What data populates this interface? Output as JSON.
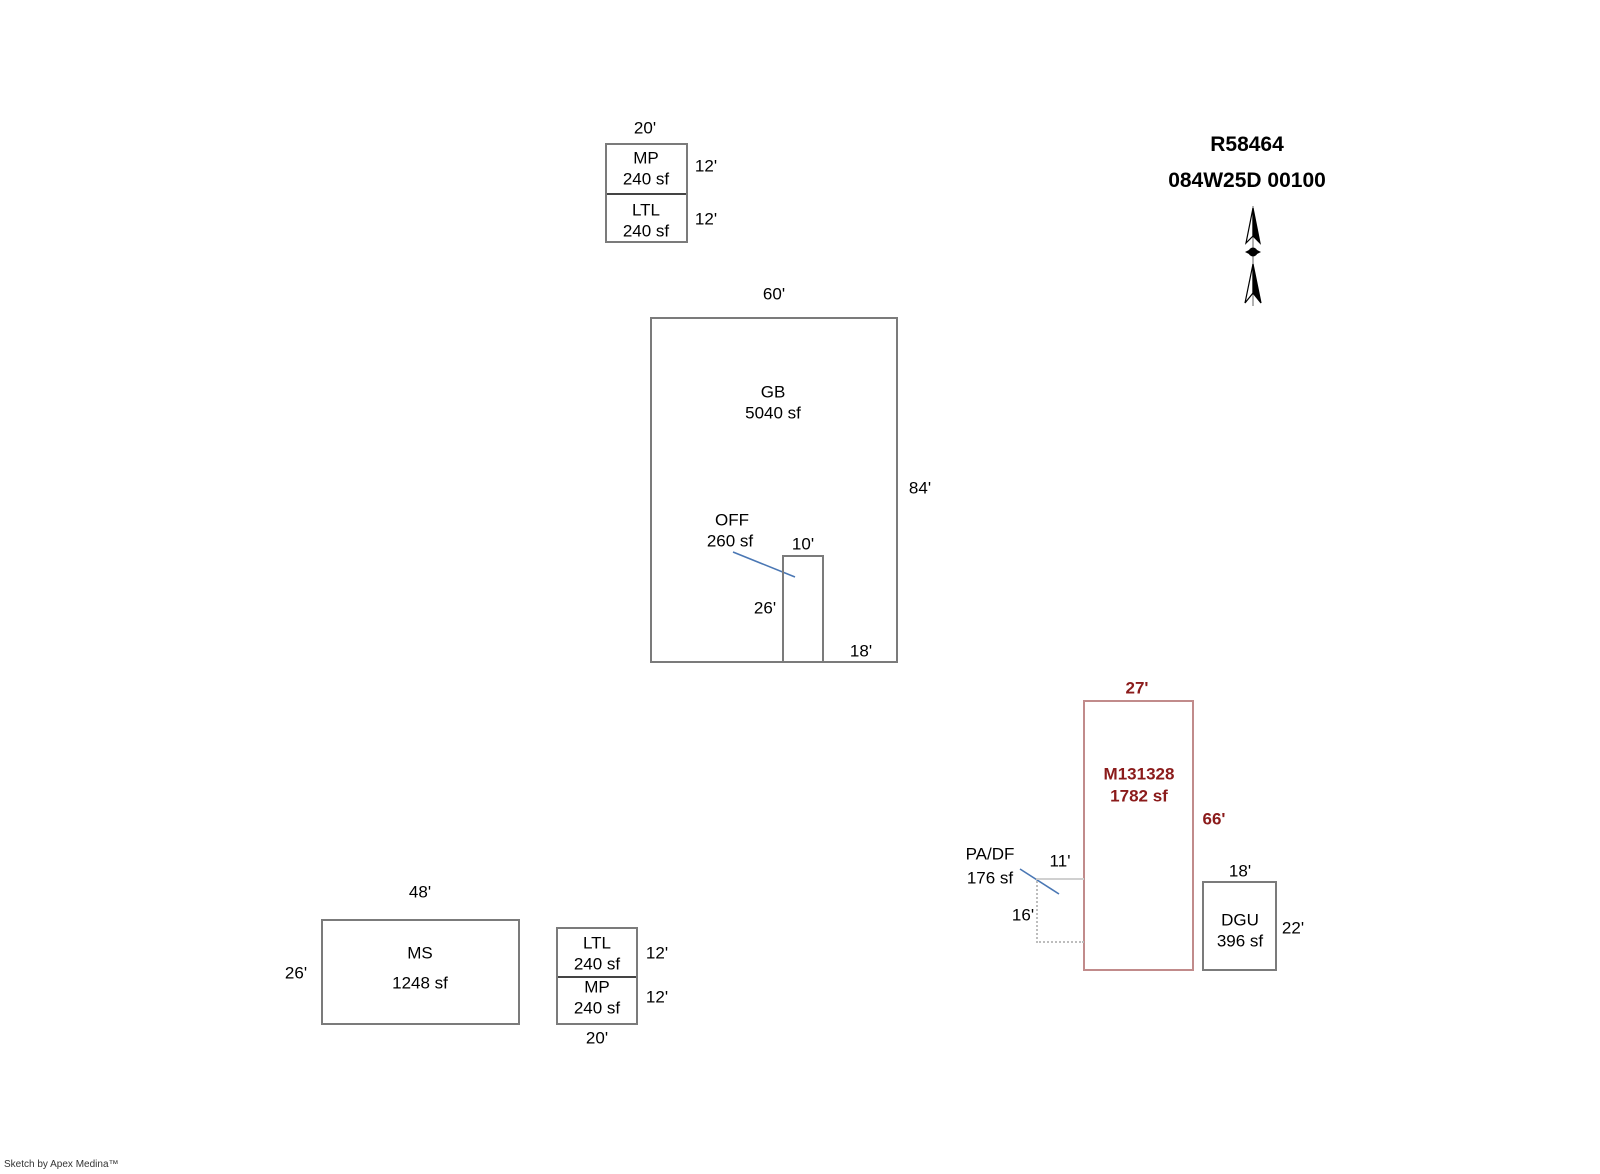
{
  "header": {
    "parcel_id": "R58464",
    "map_taxlot": "084W25D 00100"
  },
  "icons": {
    "north_arrow": "north-arrow"
  },
  "footer": {
    "credit": "Sketch by Apex Medina™"
  },
  "colors": {
    "outline_gray": "#7b7b7b",
    "cell_divider": "#444444",
    "highlight_red_text": "#8b1b1b",
    "highlight_red_outline": "#c18b8b",
    "leader_blue": "#4a77b4",
    "dotted_gray": "#bdbdbd"
  },
  "buildings": {
    "mp_ltl_top": {
      "dim_top": "20'",
      "cells": [
        {
          "label": "MP",
          "area": "240 sf",
          "dim_right": "12'"
        },
        {
          "label": "LTL",
          "area": "240 sf",
          "dim_right": "12'"
        }
      ]
    },
    "gb": {
      "label": "GB",
      "area": "5040 sf",
      "dim_top": "60'",
      "dim_right": "84'",
      "dim_bottom_inner": "18'"
    },
    "off": {
      "label": "OFF",
      "area": "260 sf",
      "dim_top": "10'",
      "dim_left": "26'"
    },
    "ms": {
      "label": "MS",
      "area": "1248 sf",
      "dim_top": "48'",
      "dim_left": "26'"
    },
    "ltl_mp_bottom": {
      "dim_bottom": "20'",
      "cells": [
        {
          "label": "LTL",
          "area": "240 sf",
          "dim_right": "12'"
        },
        {
          "label": "MP",
          "area": "240 sf",
          "dim_right": "12'"
        }
      ]
    },
    "m131328": {
      "label": "M131328",
      "area": "1782 sf",
      "dim_top": "27'",
      "dim_right": "66'"
    },
    "pa_df": {
      "label": "PA/DF",
      "area": "176 sf",
      "dim_top": "11'",
      "dim_left": "16'"
    },
    "dgu": {
      "label": "DGU",
      "area": "396 sf",
      "dim_top": "18'",
      "dim_right": "22'"
    }
  }
}
